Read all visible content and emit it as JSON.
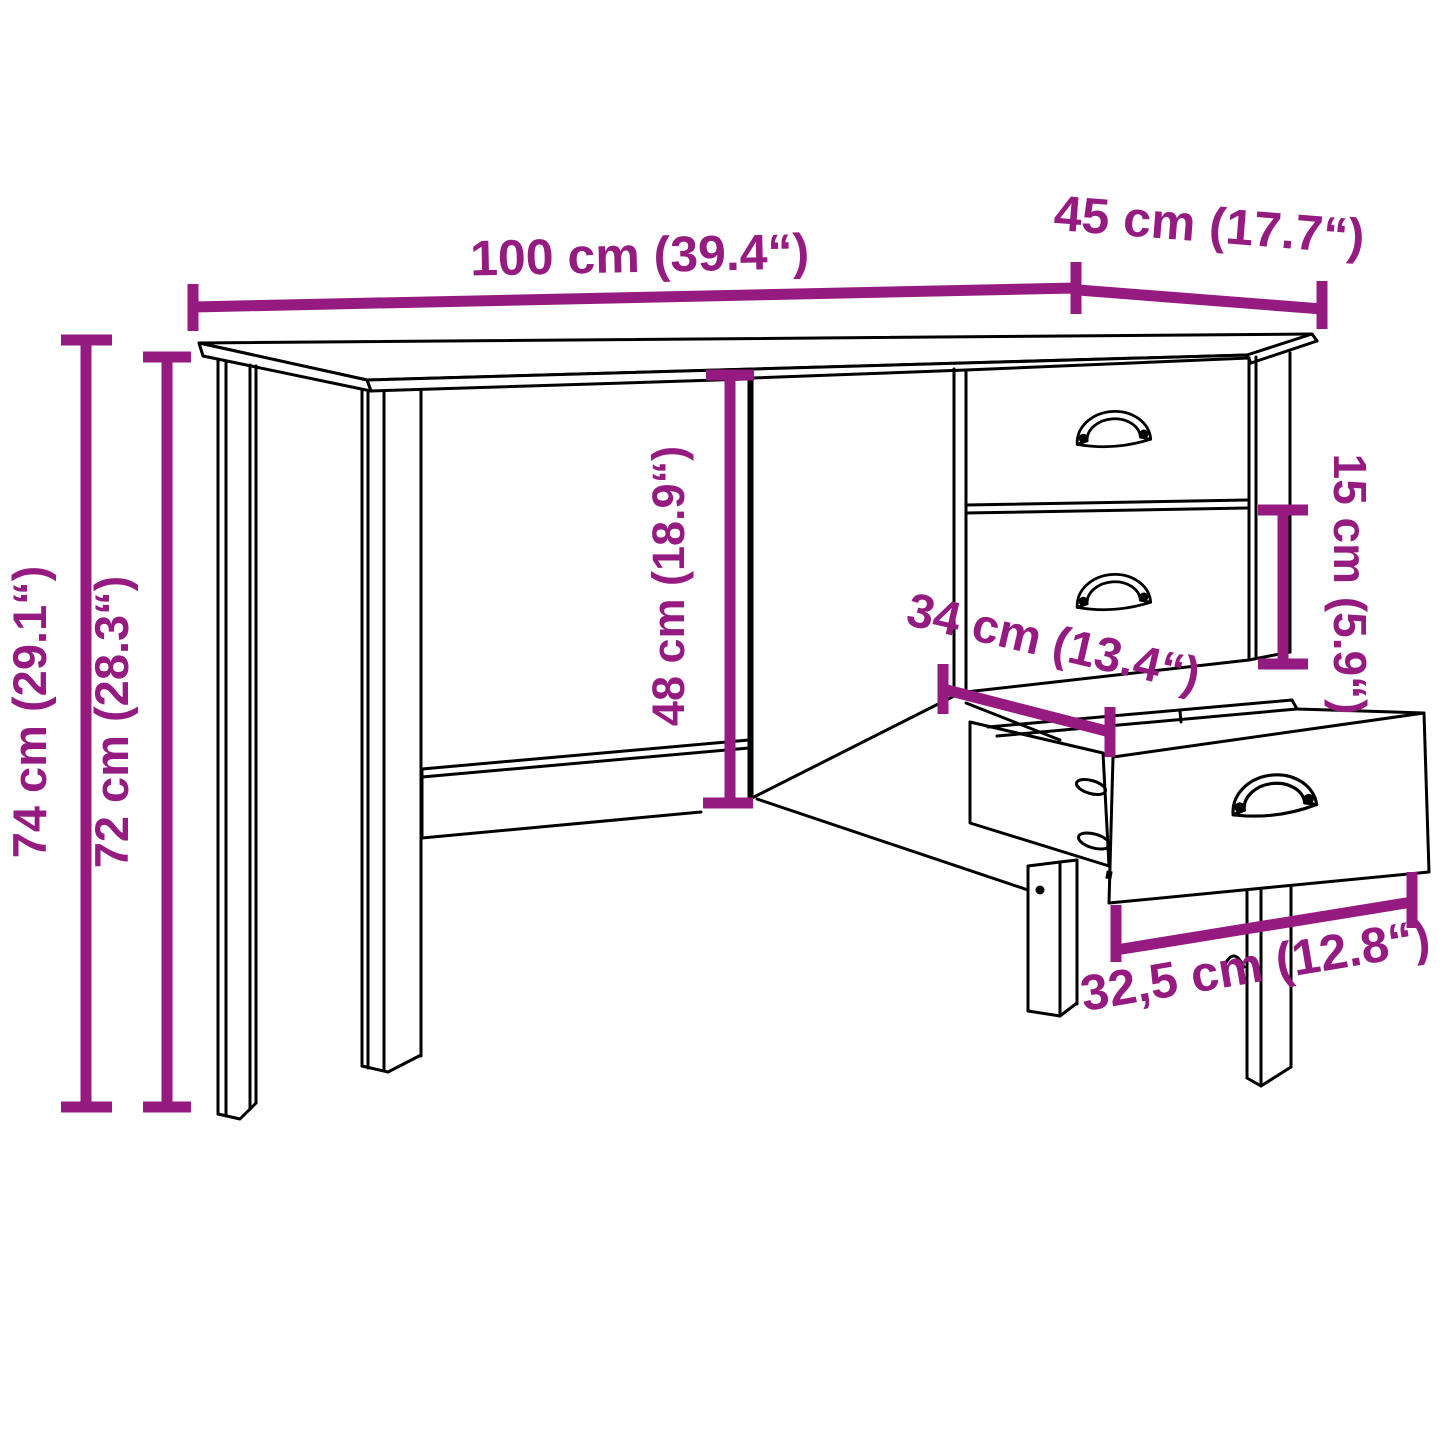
{
  "diagram": {
    "type": "furniture-dimension-diagram",
    "product": "Desk with side drawer pedestal, one drawer shown open",
    "background_color": "#ffffff",
    "outline_color": "#000000",
    "dimension_color": "#951b81",
    "dimensions": {
      "width": {
        "cm": "100",
        "inch": "39.4",
        "label": "100 cm (39.4“)"
      },
      "depth": {
        "cm": "45",
        "inch": "17.7",
        "label": "45 cm (17.7“)"
      },
      "total_height": {
        "cm": "74",
        "inch": "29.1",
        "label": "74 cm (29.1“)"
      },
      "underdesk_height": {
        "cm": "72",
        "inch": "28.3",
        "label": "72 cm (28.3“)"
      },
      "knee_clearance_height": {
        "cm": "48",
        "inch": "18.9",
        "label": "48 cm (18.9“)"
      },
      "drawer_front_height": {
        "cm": "15",
        "inch": "5.9",
        "label": "15 cm (5.9“)"
      },
      "drawer_inner_depth": {
        "cm": "34",
        "inch": "13.4",
        "label": "34 cm (13.4“)"
      },
      "drawer_inner_width": {
        "cm": "32,5",
        "inch": "12.8",
        "label": "32,5 cm (12.8“)"
      }
    }
  }
}
